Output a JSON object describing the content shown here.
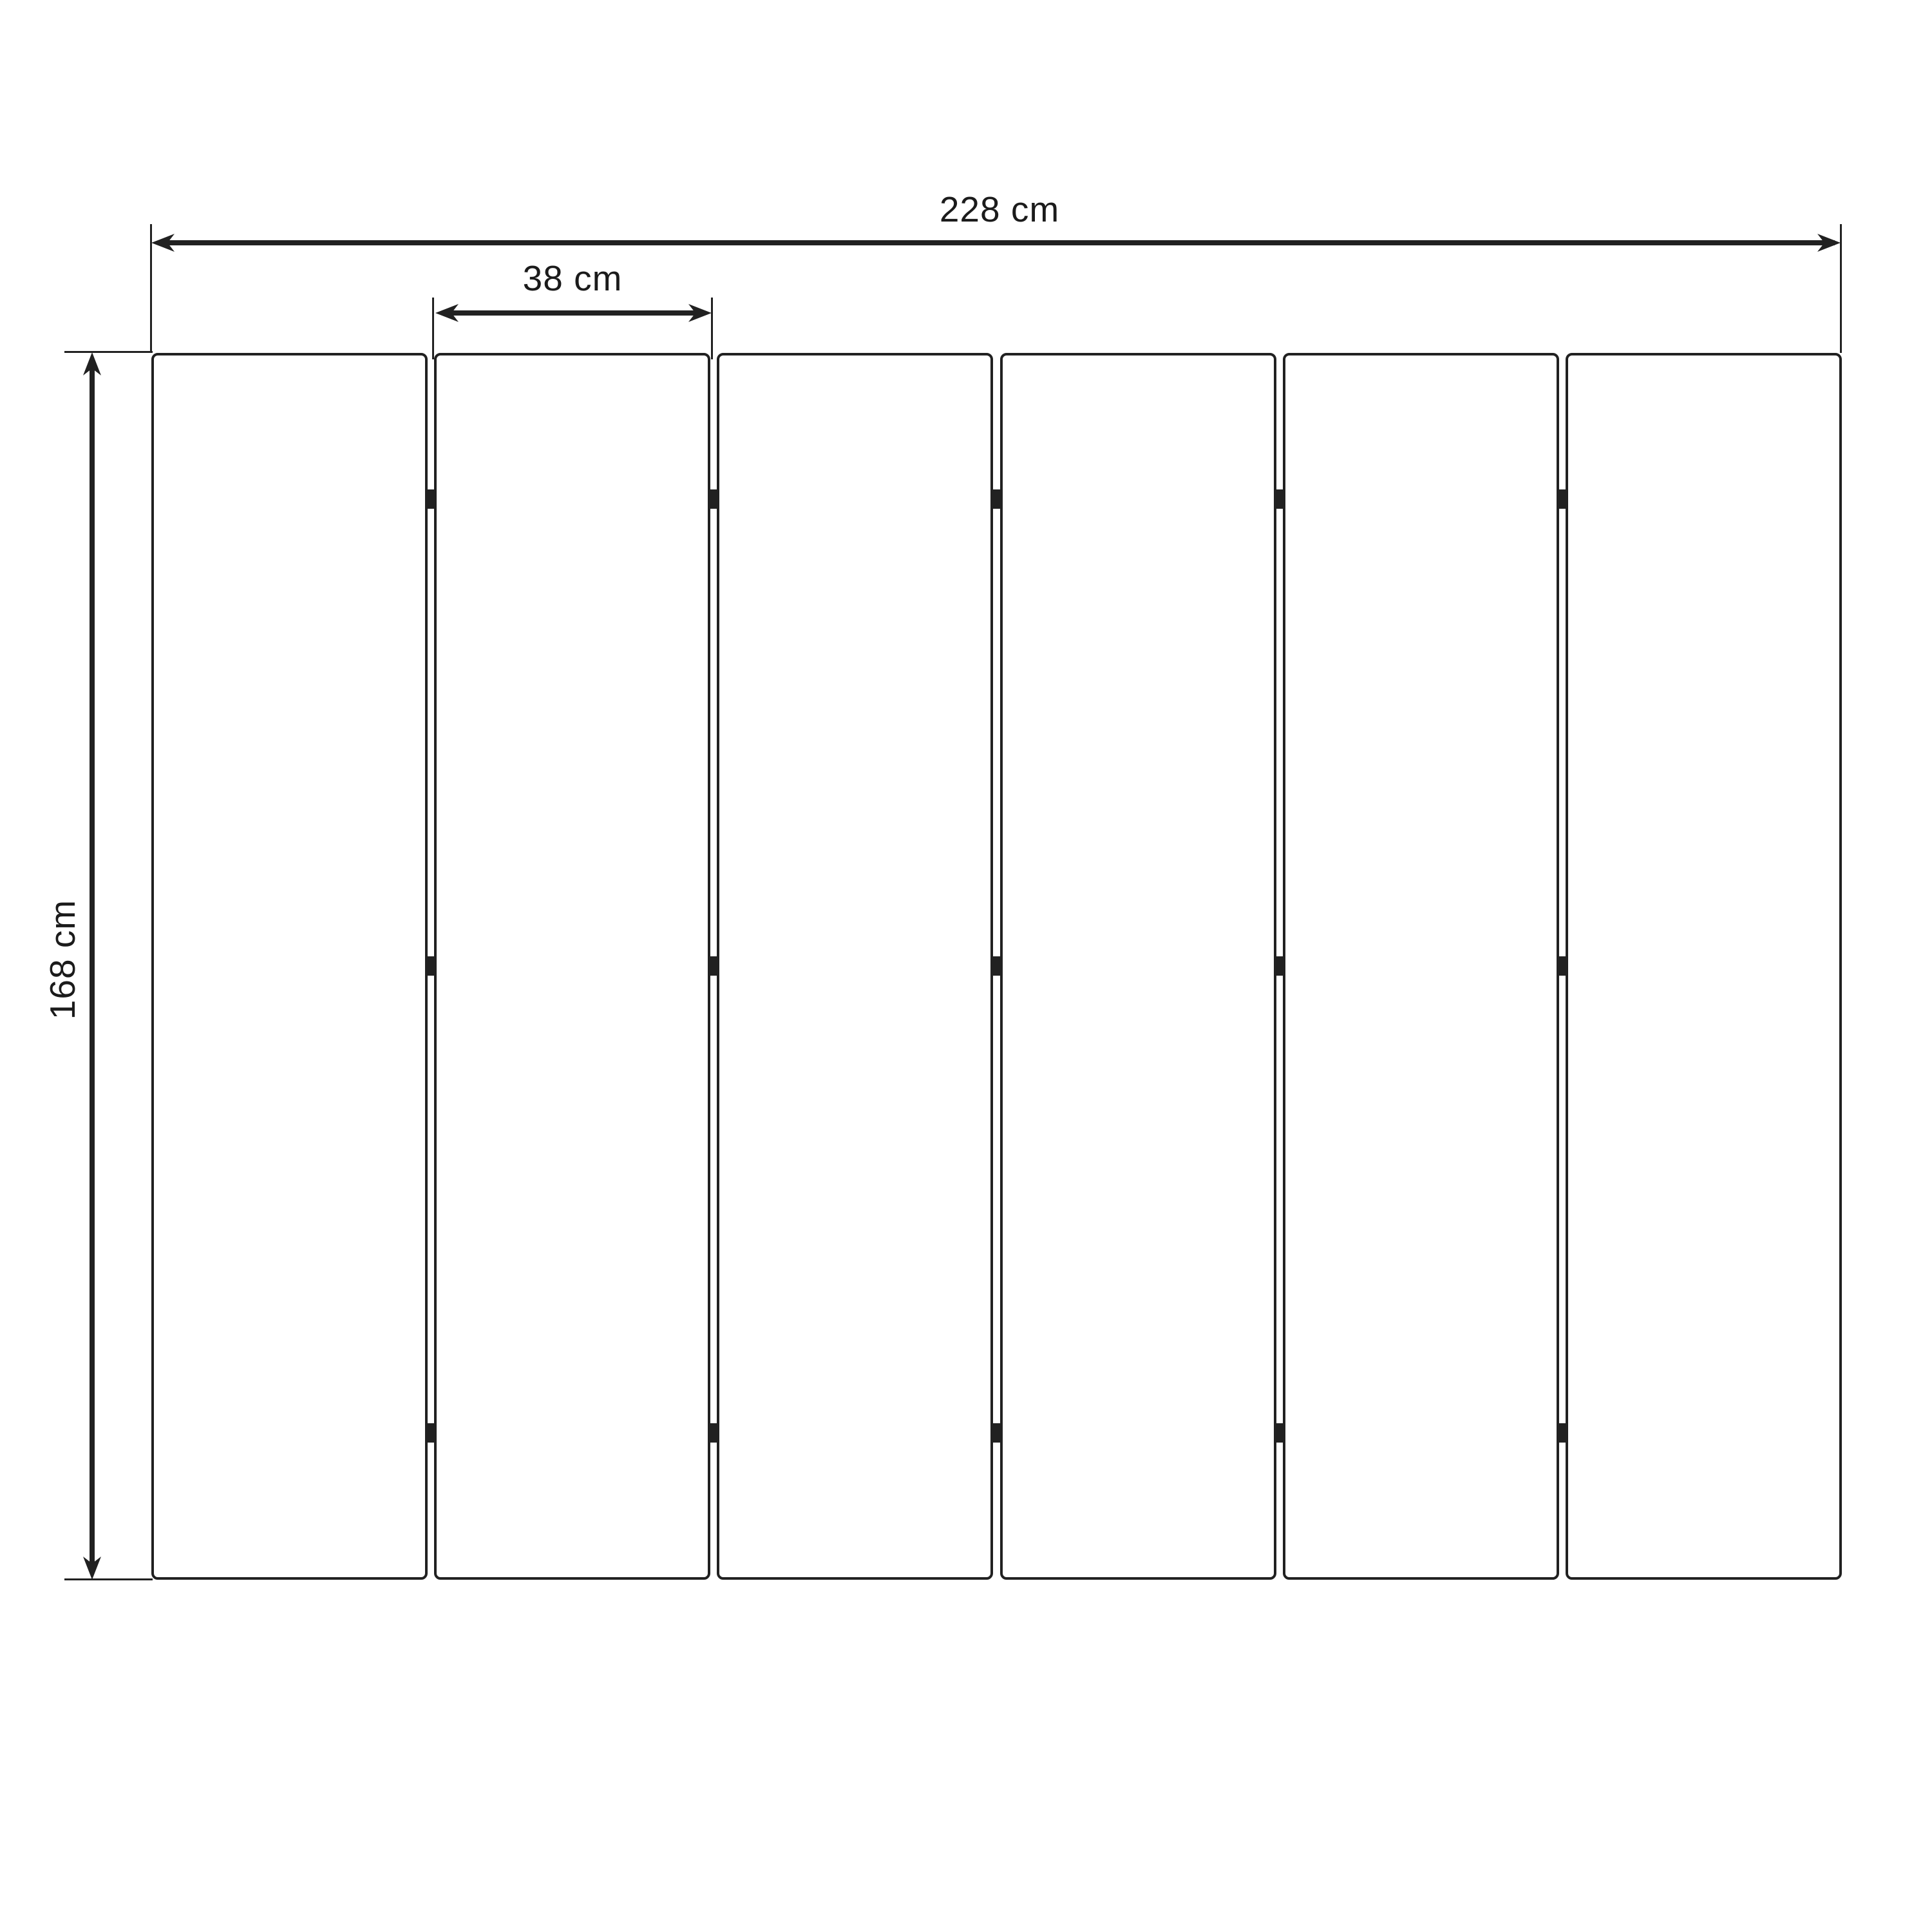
{
  "diagram": {
    "dimensions": {
      "total_width": {
        "label": "228 cm",
        "value_cm": 228
      },
      "panel_width": {
        "label": "38 cm",
        "value_cm": 38
      },
      "height": {
        "label": "168 cm",
        "value_cm": 168
      }
    },
    "panels": {
      "count": 6,
      "hinge_rows": 3
    },
    "colors": {
      "line": "#212121",
      "text": "#1b1b1b",
      "background": "#ffffff"
    }
  }
}
